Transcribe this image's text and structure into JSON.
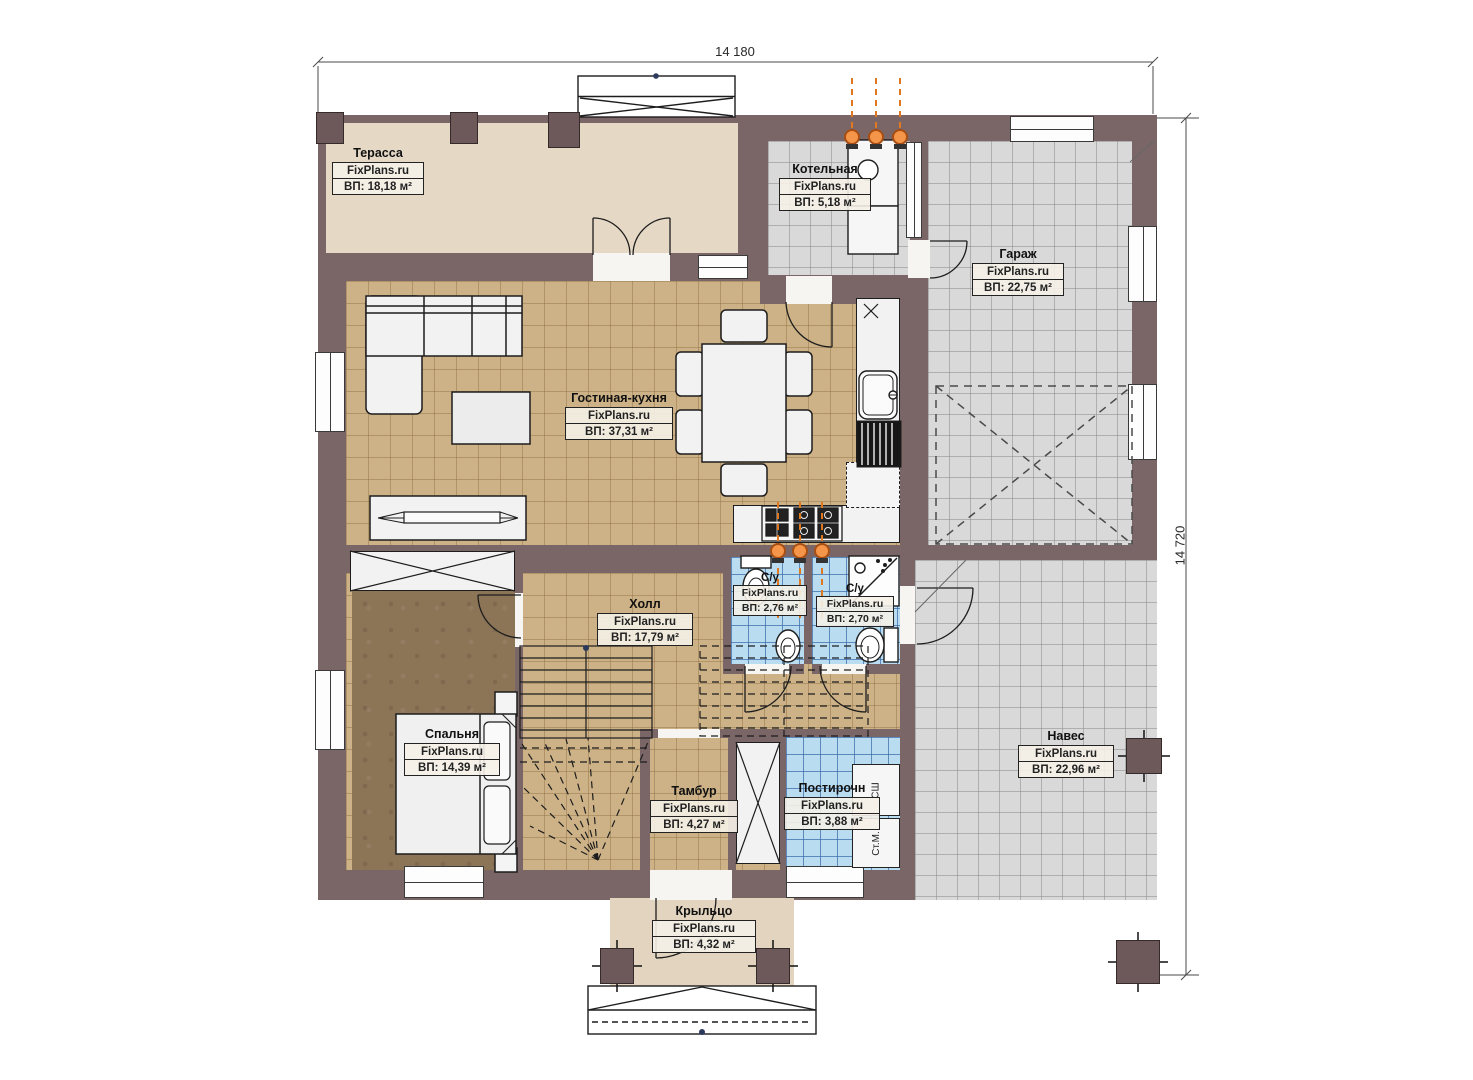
{
  "dimensions": {
    "top": "14 180",
    "right": "14 720"
  },
  "brand": "FixPlans.ru",
  "rooms": [
    {
      "id": "terrace",
      "name": "Терасса",
      "brand": "FixPlans.ru",
      "area": "ВП: 18,18 м²"
    },
    {
      "id": "boiler-room",
      "name": "Котельная",
      "brand": "FixPlans.ru",
      "area": "ВП: 5,18 м²"
    },
    {
      "id": "garage",
      "name": "Гараж",
      "brand": "FixPlans.ru",
      "area": "ВП: 22,75 м²"
    },
    {
      "id": "living-kitchen",
      "name": "Гостиная-кухня",
      "brand": "FixPlans.ru",
      "area": "ВП: 37,31 м²"
    },
    {
      "id": "hall",
      "name": "Холл",
      "brand": "FixPlans.ru",
      "area": "ВП: 17,79 м²"
    },
    {
      "id": "bathroom-1",
      "name": "С/у",
      "brand": "FixPlans.ru",
      "area": "ВП: 2,76 м²"
    },
    {
      "id": "bathroom-2",
      "name": "С/у",
      "brand": "FixPlans.ru",
      "area": "ВП: 2,70 м²"
    },
    {
      "id": "bedroom",
      "name": "Спальня",
      "brand": "FixPlans.ru",
      "area": "ВП: 14,39 м²"
    },
    {
      "id": "vestibule",
      "name": "Тамбур",
      "brand": "FixPlans.ru",
      "area": "ВП: 4,27 м²"
    },
    {
      "id": "laundry",
      "name": "Постирочн",
      "brand": "FixPlans.ru",
      "area": "ВП: 3,88 м²"
    },
    {
      "id": "canopy",
      "name": "Навес",
      "brand": "FixPlans.ru",
      "area": "ВП: 22,96 м²"
    },
    {
      "id": "porch",
      "name": "Крыльцо",
      "brand": "FixPlans.ru",
      "area": "ВП: 4,32 м²"
    }
  ],
  "appliances": {
    "dryer": "СШ",
    "washer": "Ст.М."
  },
  "colors": {
    "wall": "#7b6667",
    "floor_tan": "#cdb287",
    "floor_gray": "#d9d9d9",
    "floor_blue": "#badcf0",
    "floor_terrace": "#e5d9c6",
    "floor_bedroom": "#8c7457",
    "utility": "#e07820"
  }
}
